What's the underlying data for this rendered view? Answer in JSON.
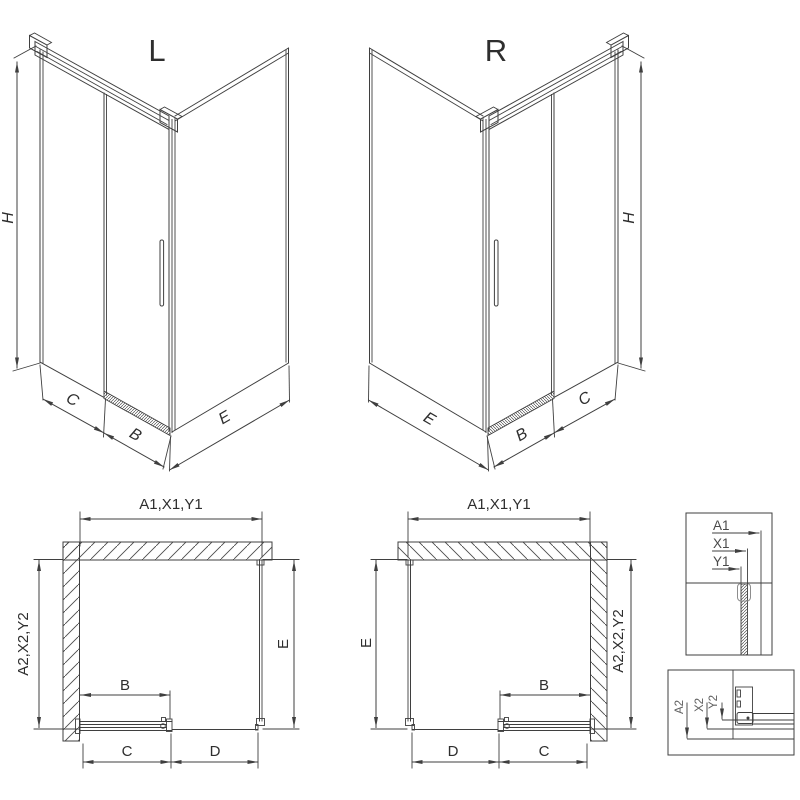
{
  "palette": {
    "line": "#3f3f3f",
    "text": "#2e2e2e",
    "muted": "#5f5f5f",
    "background": "#ffffff"
  },
  "views": {
    "iso_left": {
      "title": "L",
      "h": "H",
      "c": "C",
      "b": "B",
      "e": "E"
    },
    "iso_right": {
      "title": "R",
      "h": "H",
      "e": "E",
      "b": "B",
      "c": "C"
    },
    "plan_left": {
      "width": "A1,X1,Y1",
      "depth": "A2,X2,Y2",
      "e": "E",
      "b": "B",
      "c": "C",
      "d": "D"
    },
    "plan_right": {
      "width": "A1,X1,Y1",
      "depth": "A2,X2,Y2",
      "e": "E",
      "b": "B",
      "c": "C",
      "d": "D"
    },
    "detail_width": {
      "labels": [
        "A1",
        "X1",
        "Y1"
      ]
    },
    "detail_depth": {
      "labels": [
        "A2",
        "X2",
        "Y2"
      ]
    }
  }
}
